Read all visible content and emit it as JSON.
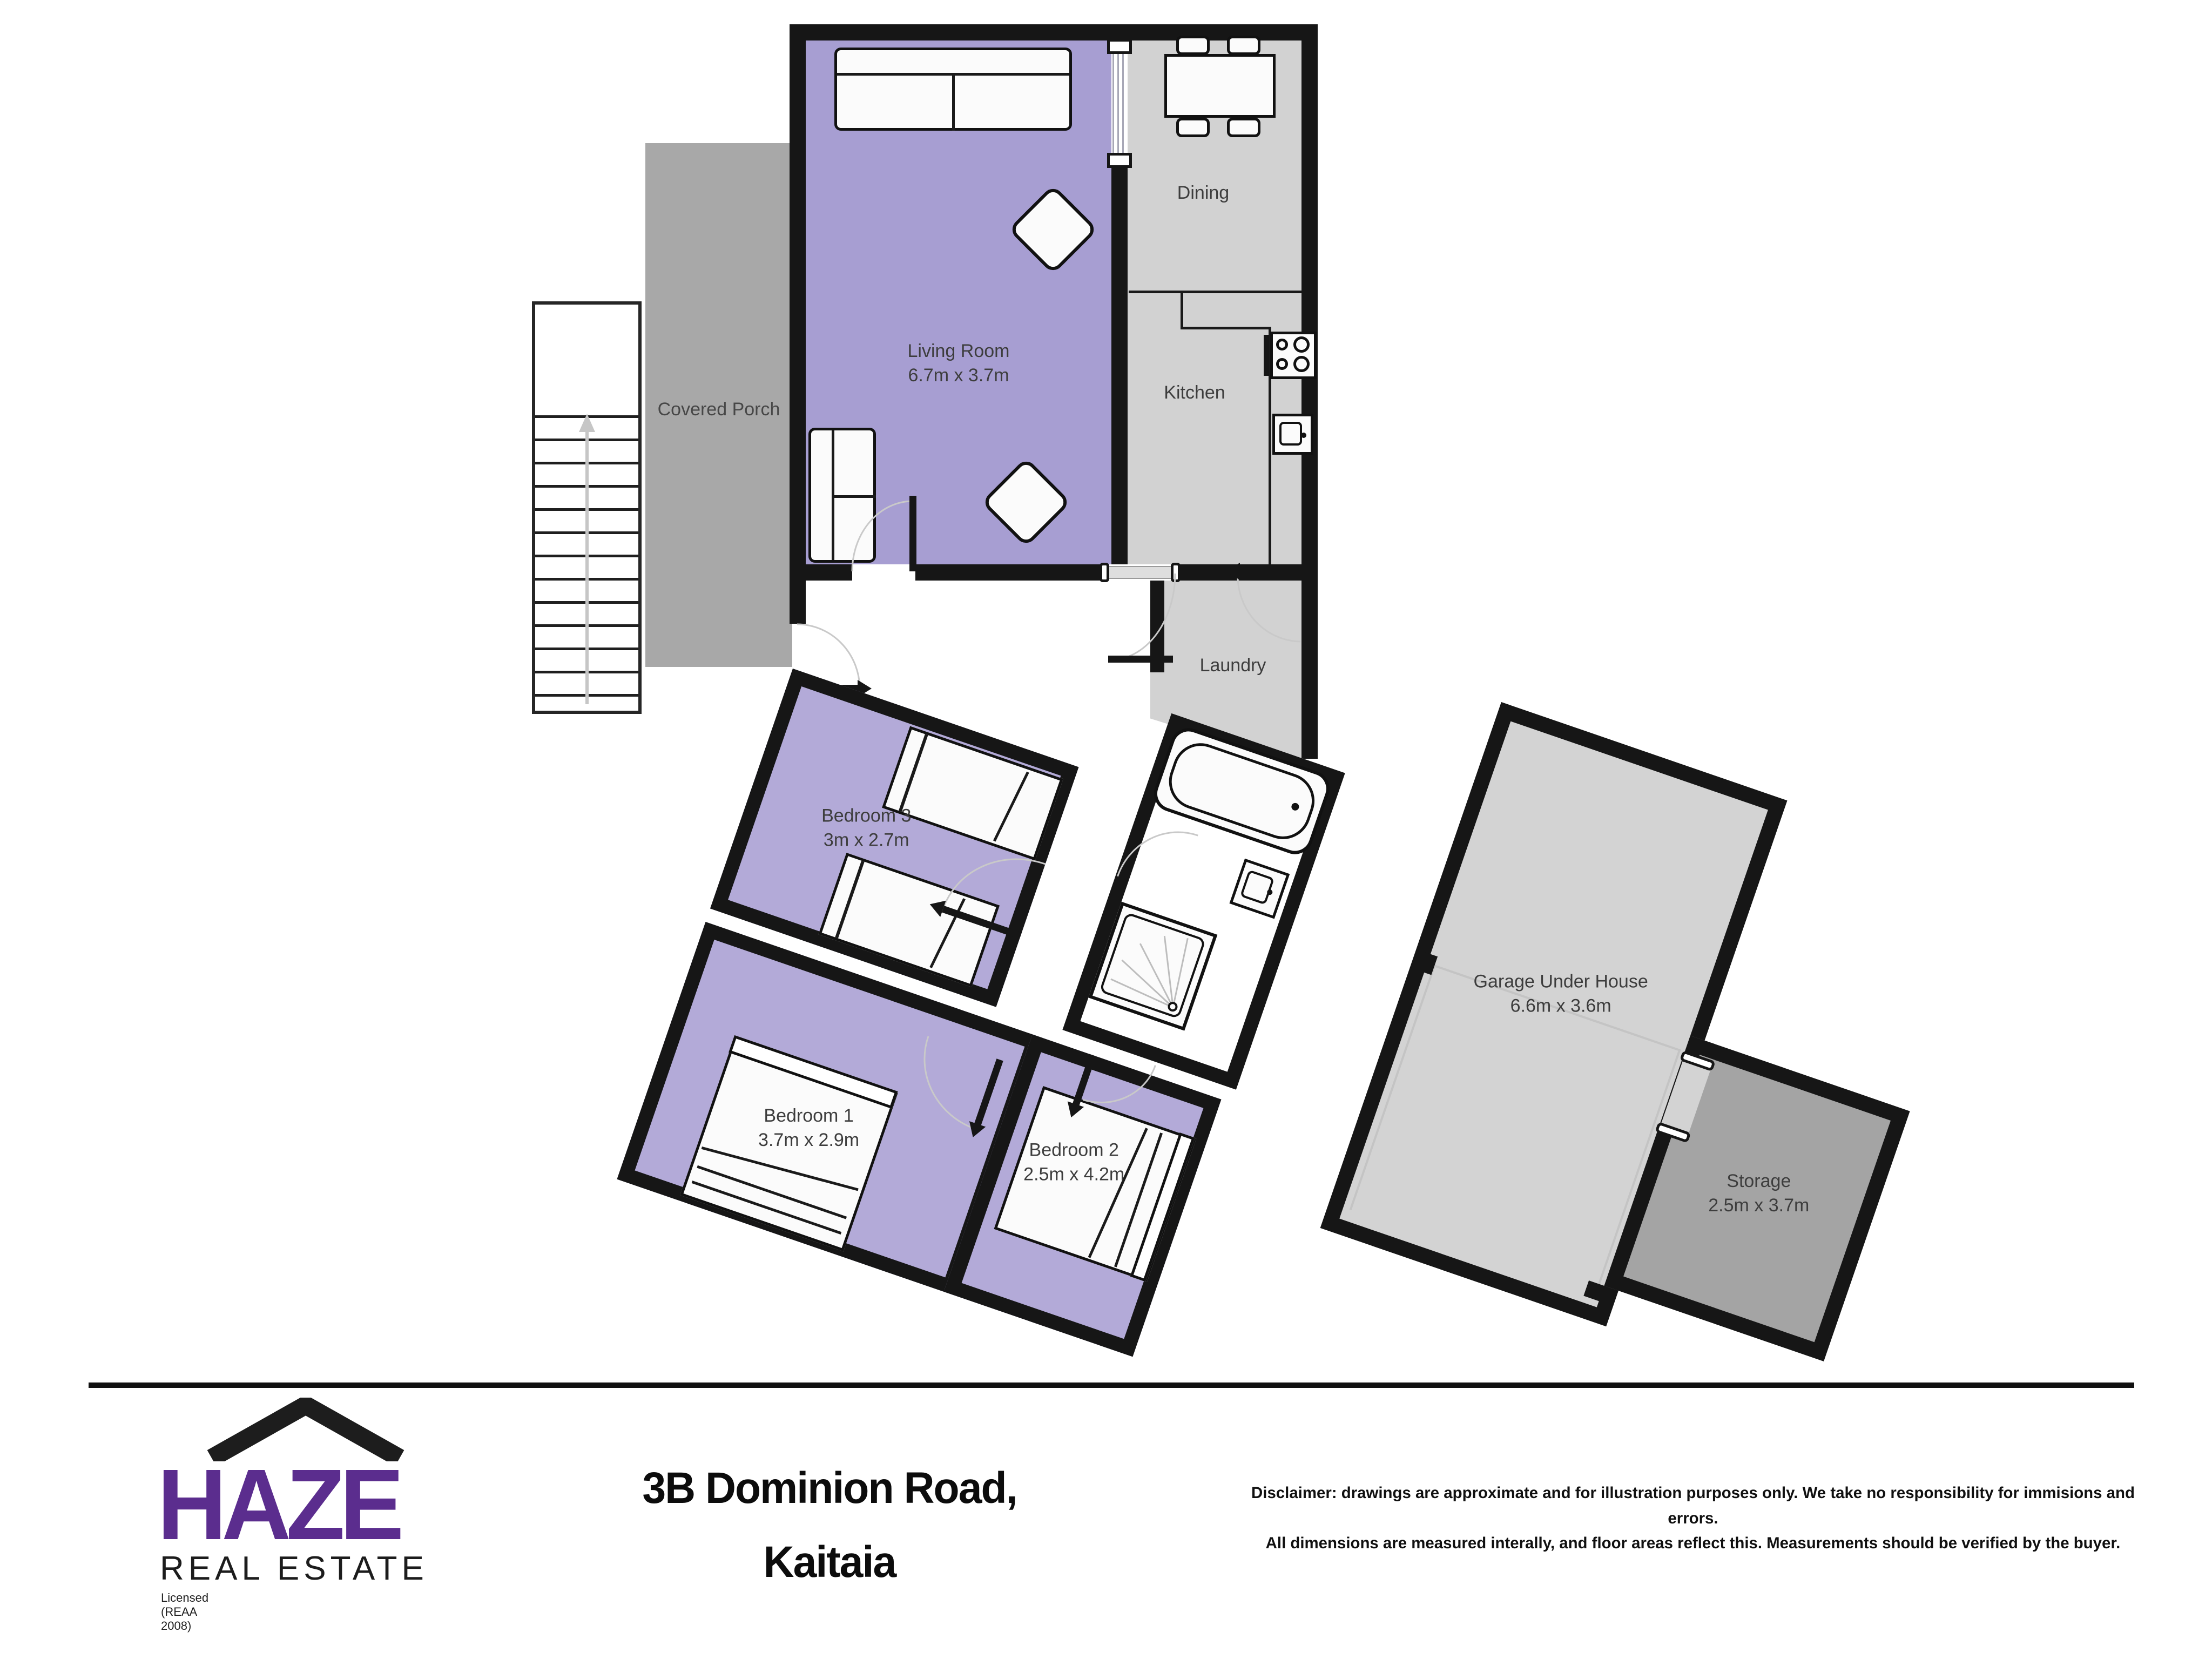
{
  "colors": {
    "wall": "#161616",
    "living_purple": "#a79ed2",
    "bedroom_purple": "#b3aad8",
    "room_gray": "#d2d2d2",
    "porch_gray": "#a8a8a8",
    "storage_gray": "#a4a4a4",
    "label_gray": "#3d3d3d",
    "logo_purple": "#5b2d8e"
  },
  "floorplan": {
    "rooms": {
      "living_room": {
        "name": "Living Room",
        "dims": "6.7m x 3.7m"
      },
      "dining": {
        "name": "Dining"
      },
      "kitchen": {
        "name": "Kitchen"
      },
      "covered_porch": {
        "name": "Covered Porch"
      },
      "laundry": {
        "name": "Laundry"
      },
      "bedroom_3": {
        "name": "Bedroom 3",
        "dims": "3m x 2.7m"
      },
      "bedroom_1": {
        "name": "Bedroom 1",
        "dims": "3.7m x 2.9m"
      },
      "bedroom_2": {
        "name": "Bedroom 2",
        "dims": "2.5m x 4.2m"
      },
      "garage": {
        "name": "Garage Under House",
        "dims": "6.6m x 3.6m"
      },
      "storage": {
        "name": "Storage",
        "dims": "2.5m x 3.7m"
      }
    }
  },
  "footer": {
    "logo": {
      "brand": "HAZE",
      "subtitle": "REAL ESTATE",
      "license": "Licensed (REAA 2008)"
    },
    "address_line1": "3B Dominion Road,",
    "address_line2": "Kaitaia",
    "disclaimer_line1": "Disclaimer: drawings are approximate and for illustration purposes only. We take no responsibility for immisions and errors.",
    "disclaimer_line2": "All dimensions are measured interally, and floor areas reflect this. Measurements should be verified by the buyer."
  }
}
